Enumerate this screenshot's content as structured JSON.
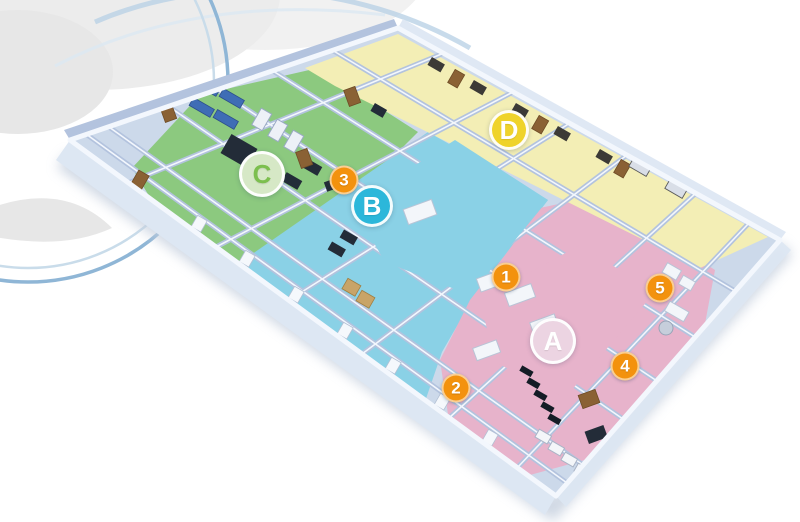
{
  "scene": {
    "type": "isometric-floorplan-rendering",
    "background_color": "#ffffff",
    "width": 800,
    "height": 522
  },
  "building": {
    "floor_color": "#ccd9ea",
    "interior_wall_color": "#b3c3de",
    "wall_top_color": "#f3f7fd",
    "exterior_wall_color": "#dde7f3",
    "shadow_color": "#c3cedd"
  },
  "decor": {
    "cloud_color": "#ececec",
    "swirl_color": "#e7e7e7",
    "arc_outer_color": "#8fb6d6",
    "arc_inner_color": "#c9dcea",
    "swoosh_color": "#bad2e6",
    "swoosh_light_color": "#dce9f2"
  },
  "zones": [
    {
      "marker": "A",
      "color": "#e7b3cb",
      "position": "lower-right"
    },
    {
      "marker": "B",
      "color": "#8ad1e6",
      "position": "center"
    },
    {
      "marker": "C",
      "color": "#8cc97f",
      "position": "upper-left"
    },
    {
      "marker": "D",
      "color": "#f3eeb5",
      "position": "upper-right"
    }
  ],
  "markers": {
    "letters": [
      {
        "label": "A",
        "x": 553,
        "y": 341,
        "size": 46,
        "fill": "#ecd4e2",
        "text": "#ffffff"
      },
      {
        "label": "B",
        "x": 372,
        "y": 206,
        "size": 42,
        "fill": "#2cb7da",
        "text": "#ffffff"
      },
      {
        "label": "C",
        "x": 262,
        "y": 174,
        "size": 46,
        "fill": "#d6e8c6",
        "text": "#7cbf4e"
      },
      {
        "label": "D",
        "x": 509,
        "y": 130,
        "size": 40,
        "fill": "#efd32b",
        "text": "#ffffff"
      }
    ],
    "numbers": [
      {
        "label": "1",
        "x": 506,
        "y": 277
      },
      {
        "label": "2",
        "x": 456,
        "y": 388
      },
      {
        "label": "3",
        "x": 344,
        "y": 180
      },
      {
        "label": "4",
        "x": 625,
        "y": 366
      },
      {
        "label": "5",
        "x": 660,
        "y": 288
      }
    ],
    "number_fill": "#f3920e",
    "number_text": "#ffffff"
  }
}
